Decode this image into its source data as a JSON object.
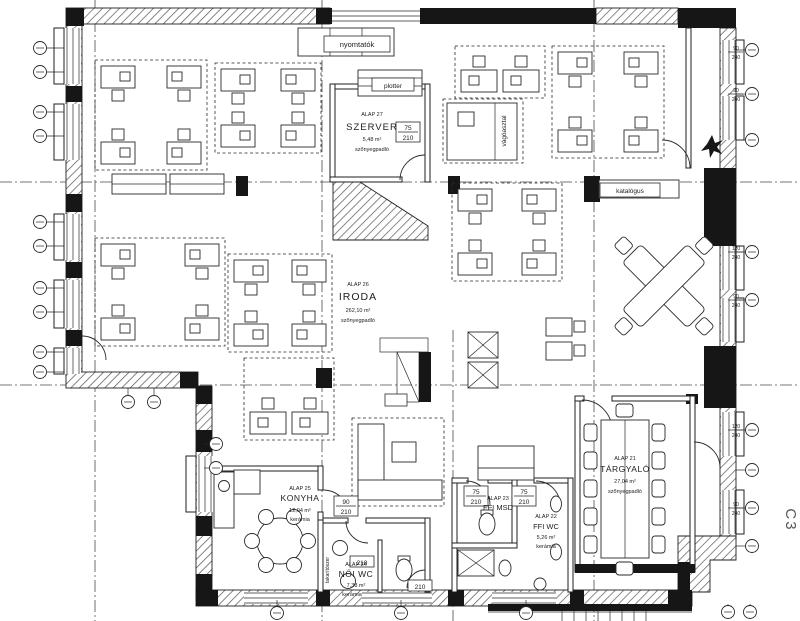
{
  "rooms": {
    "szerver": {
      "code": "ALAP 27",
      "name": "SZERVER",
      "area": "5,48 m²",
      "floor": "szőnyegpadló"
    },
    "iroda": {
      "code": "ALAP 26",
      "name": "IRODA",
      "area": "262,10 m²",
      "floor": "szőnyegpadló"
    },
    "konyha": {
      "code": "ALAP 25",
      "name": "KONYHA",
      "area": "12,04 m²",
      "floor": "kerámia"
    },
    "noi_wc": {
      "code": "ALAP 24",
      "name": "NŐI WC",
      "area": "7,38 m²",
      "floor": "kerámia"
    },
    "ffi_msd": {
      "code": "ALAP 23",
      "name": "FFI MSD"
    },
    "ffi_wc": {
      "code": "ALAP 22",
      "name": "FFI WC",
      "area": "5,26 m²",
      "floor": "kerámia"
    },
    "targyalo": {
      "code": "ALAP 21",
      "name": "TÁRGYALÓ",
      "area": "27,04 m²",
      "floor": "szőnyegpadló"
    }
  },
  "labels": {
    "nyomtatok": "nyomtatók",
    "plotter": "plotter",
    "katalogus": "katalógus",
    "vagoasztal": "vágóasztal",
    "takaritoszer": "takarítószer",
    "section": "C3"
  },
  "door_labels": {
    "szerver": {
      "w": "75",
      "h": "210"
    },
    "konyha": {
      "w": "90",
      "h": "210"
    },
    "ffi_msd": {
      "w": "75",
      "h": "210"
    },
    "ffi_wc": {
      "w": "75",
      "h": "210"
    },
    "noi_wc_1": {
      "h": "210"
    },
    "noi_wc_2": {
      "h": "210"
    }
  },
  "window_labels": [
    {
      "w": "90",
      "h": "240"
    },
    {
      "w": "90",
      "h": "240"
    },
    {
      "w": "120",
      "h": "240"
    },
    {
      "w": "90",
      "h": "240"
    },
    {
      "w": "120",
      "h": "240"
    },
    {
      "w": "90",
      "h": "240"
    }
  ],
  "colors": {
    "ink": "#1f1f1f",
    "wall_fill": "#161616",
    "background": "#ffffff",
    "section_mark": "#555555"
  }
}
